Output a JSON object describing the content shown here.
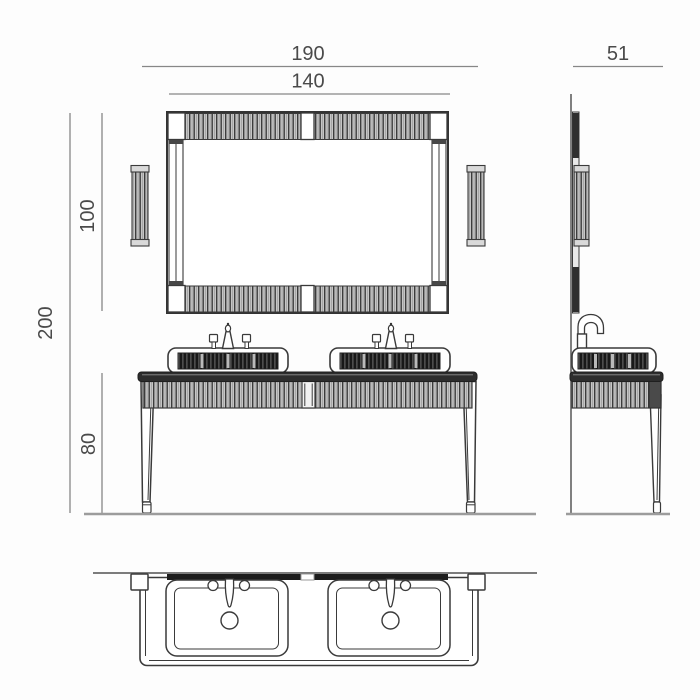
{
  "dimensions": {
    "overall_width": "190",
    "mirror_width": "140",
    "depth": "51",
    "mirror_height": "100",
    "overall_height": "200",
    "console_height": "80"
  },
  "colors": {
    "background": "#fdfdfd",
    "line": "#3a3a3a",
    "dim_line": "#878787",
    "dim_text": "#4a4a4a",
    "ground": "#9c9c9c",
    "wall": "#6a6a6a",
    "slab": "#2d2d2d",
    "flute_light_bg": "#c6c6c6",
    "flute_dark_bg": "#181818"
  }
}
